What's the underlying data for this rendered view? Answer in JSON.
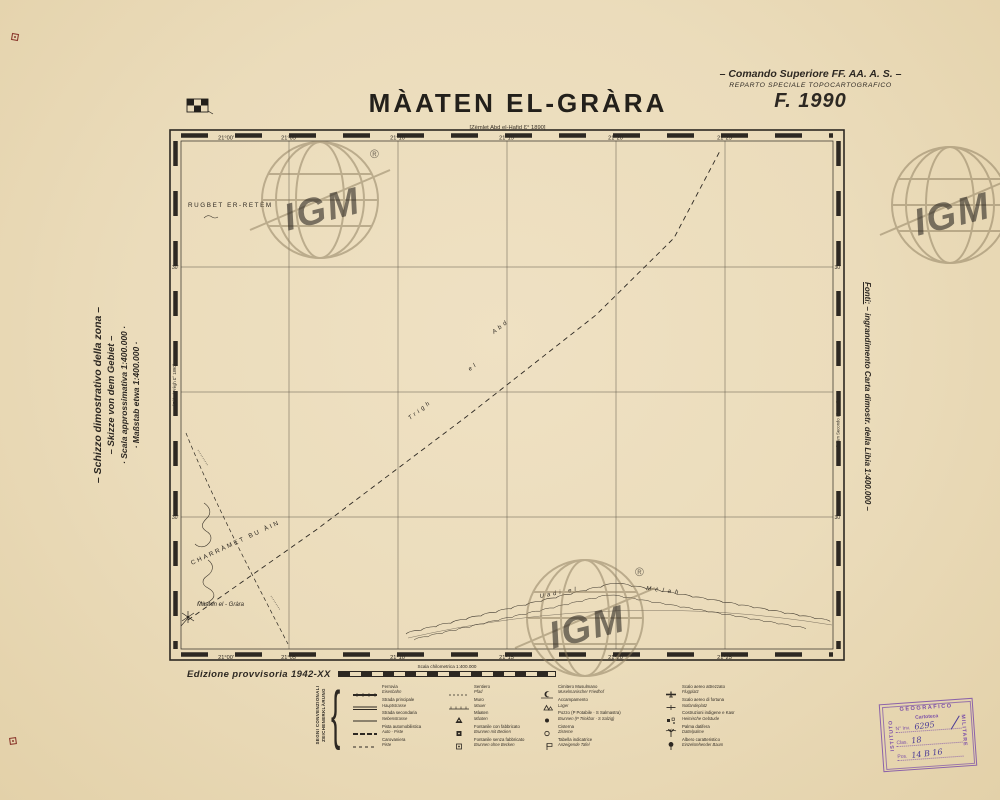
{
  "header": {
    "title": "MÀATEN EL-GRÀRA",
    "bracket_note": "[Zèmlet Abd el-Hafid Ɛ° 1890]",
    "command_line1": "– Comando Superiore FF. AA. A. S. –",
    "command_line2": "REPARTO SPECIALE TOPOCARTOGRAFICO",
    "sheet": "F. 1990"
  },
  "left_notes": {
    "line1": "– Schizzo dimostrativo della zona –",
    "line2": "– Skizze von dem Gebiet –",
    "line3": "· Scala approssimativa 1:400.000 ·",
    "line4": "· Maßstab etwa 1:400.000 ·"
  },
  "right_note": {
    "label": "Fonti:",
    "text": " – ingrandimento Carta dimostr. della Libia 1:400.000 –"
  },
  "map": {
    "top_labels": [
      "21°00'",
      "21°05'",
      "21°10'",
      "21°15'",
      "21°20'",
      "21°25'"
    ],
    "bottom_labels": [
      "21°00'",
      "21°05'",
      "21°10'",
      "21°15'",
      "21°20'",
      "21°25'"
    ],
    "left_lat_labels": [
      "30'",
      "30'"
    ],
    "right_lat_labels": [
      "30'",
      "30'"
    ],
    "edge_note_left": "[Gèbel Frègh Ɛ° 1890]",
    "edge_note_right": "[Alàm Secondo Ɛ° 1891]",
    "place_rugbet": "RUGBET ER-RETÈM",
    "place_charramet": "CHARRÀMET BU ÀIN",
    "route_word1": "Trigh",
    "route_word2": "el",
    "route_word3": "Abd",
    "wadi_word1": "Uadi el",
    "wadi_word2": "Mèlah",
    "place_maaten": "Màaten el - Gràra"
  },
  "footer": {
    "edition": "Edizione provvisoria 1942-XX",
    "scale_caption": "Scala chilometrica 1:400.000"
  },
  "legend": {
    "heading1": "SEGNI CONVENZIONALI",
    "heading2": "ZEICHENERKLÄRUNG",
    "brace": "{",
    "col1": [
      {
        "it": "Ferrovia",
        "de": "Eisenbahn"
      },
      {
        "it": "Strada principale",
        "de": "Hauptstrasse"
      },
      {
        "it": "Strada secondaria",
        "de": "Nebenstrasse"
      },
      {
        "it": "Pista automobilistica",
        "de": "Auto - Piste"
      },
      {
        "it": "Carovaniera",
        "de": "Piste"
      }
    ],
    "col2": [
      {
        "it": "Sentiero",
        "de": "Pfad"
      },
      {
        "it": "Muro",
        "de": "Mauer"
      },
      {
        "it": "Màaten",
        "de": "Màaten"
      },
      {
        "it": "Fontanile con fabbricato",
        "de": "Brunnen mit Becken"
      },
      {
        "it": "Fontanile senza fabbricato",
        "de": "Brunnen ohne Becken"
      }
    ],
    "col3": [
      {
        "it": "Cimitero Musulmano",
        "de": "Muselmanischer Friedhof"
      },
      {
        "it": "Accampamento",
        "de": "Lager"
      },
      {
        "it": "Pozzo (P Potabile · S Salmastra)",
        "de": "Brunnen (P Trinkbar · S Salzig)"
      },
      {
        "it": "Cisterna",
        "de": "Zisterne"
      },
      {
        "it": "Tabella indicatrice",
        "de": "Anzeigende Tafel"
      }
    ],
    "col4": [
      {
        "it": "Scalo aereo attrezzato",
        "de": "Flugplatz"
      },
      {
        "it": "Scalo aereo di fortuna",
        "de": "Notlandeplatz"
      },
      {
        "it": "Costruzioni indigene e Kasr",
        "de": "Heimische Gebäude"
      },
      {
        "it": "Palma datifera",
        "de": "Dattelpalme"
      },
      {
        "it": "Albero caratteristico",
        "de": "Einzelstehender Baum"
      }
    ]
  },
  "stamp": {
    "left": "ISTITUTO",
    "top": "GEOGRAFICO",
    "right": "MILITARE",
    "org": "Cartoteca",
    "inv_label": "N° Inv.",
    "inv_value": "6295",
    "clas_label": "Clas.",
    "clas_value": "18",
    "pos_label": "Pos.",
    "pos_value": "14 B 16"
  },
  "watermark": {
    "text": "IGM",
    "reg": "®"
  }
}
